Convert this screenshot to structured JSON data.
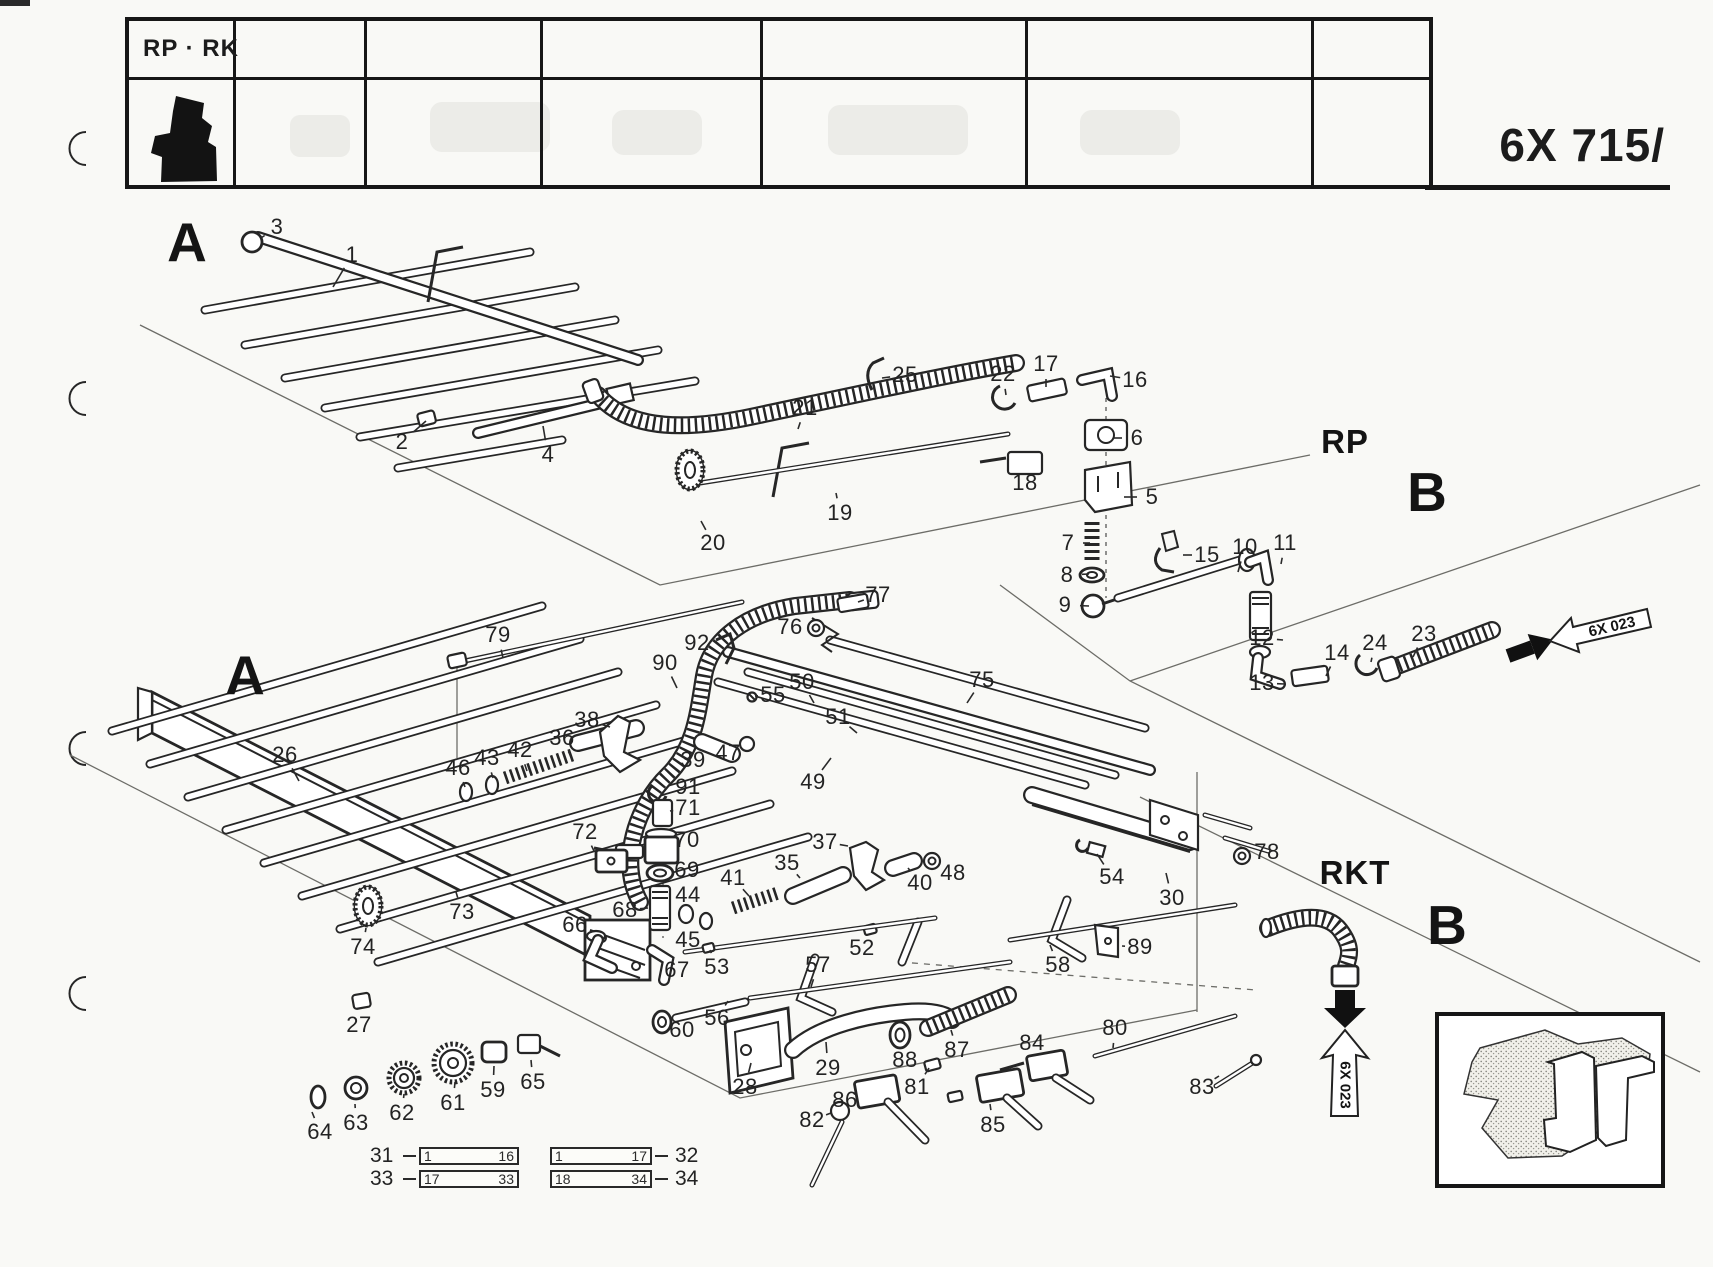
{
  "page": {
    "header_label": "RP · RK",
    "code": "6X 715/"
  },
  "sections": [
    {
      "label": "A",
      "x": 187,
      "y": 242,
      "size": "xl"
    },
    {
      "label": "A",
      "x": 245,
      "y": 675,
      "size": "xl"
    },
    {
      "label": "RP",
      "x": 1345,
      "y": 442,
      "size": "lg"
    },
    {
      "label": "B",
      "x": 1427,
      "y": 492,
      "size": "xl"
    },
    {
      "label": "RKT",
      "x": 1355,
      "y": 873,
      "size": "lg"
    },
    {
      "label": "B",
      "x": 1447,
      "y": 925,
      "size": "xl"
    }
  ],
  "ref_arrows": [
    {
      "label": "6X 023",
      "x": 1612,
      "y": 627,
      "rot": -13
    },
    {
      "label": "6X 023",
      "x": 1345,
      "y": 1085,
      "rot": 90
    }
  ],
  "legend": {
    "rows": [
      {
        "left_ref": "31",
        "boxes": [
          {
            "start": "1",
            "end": "16"
          },
          {
            "start": "1",
            "end": "17"
          }
        ],
        "right_ref": "32"
      },
      {
        "left_ref": "33",
        "boxes": [
          {
            "start": "17",
            "end": "33"
          },
          {
            "start": "18",
            "end": "34"
          }
        ],
        "right_ref": "34"
      }
    ]
  },
  "parts": [
    {
      "n": "1",
      "x": 352,
      "y": 255,
      "lx": 333,
      "ly": 287
    },
    {
      "n": "2",
      "x": 402,
      "y": 442,
      "lx": 426,
      "ly": 421
    },
    {
      "n": "3",
      "x": 277,
      "y": 227,
      "lx": 261,
      "ly": 238
    },
    {
      "n": "4",
      "x": 548,
      "y": 455,
      "lx": 543,
      "ly": 426
    },
    {
      "n": "5",
      "x": 1152,
      "y": 497,
      "lx": 1124,
      "ly": 497
    },
    {
      "n": "6",
      "x": 1137,
      "y": 438,
      "lx": 1113,
      "ly": 438
    },
    {
      "n": "7",
      "x": 1068,
      "y": 543,
      "lx": 1090,
      "ly": 543
    },
    {
      "n": "8",
      "x": 1067,
      "y": 575,
      "lx": 1089,
      "ly": 574
    },
    {
      "n": "9",
      "x": 1065,
      "y": 605,
      "lx": 1089,
      "ly": 606
    },
    {
      "n": "10",
      "x": 1245,
      "y": 547,
      "lx": 1238,
      "ly": 572
    },
    {
      "n": "11",
      "x": 1285,
      "y": 543,
      "lx": 1281,
      "ly": 564
    },
    {
      "n": "12",
      "x": 1262,
      "y": 638,
      "lx": 1283,
      "ly": 640
    },
    {
      "n": "13",
      "x": 1262,
      "y": 683,
      "lx": 1285,
      "ly": 684
    },
    {
      "n": "14",
      "x": 1337,
      "y": 653,
      "lx": 1326,
      "ly": 676
    },
    {
      "n": "15",
      "x": 1207,
      "y": 555,
      "lx": 1183,
      "ly": 555
    },
    {
      "n": "16",
      "x": 1135,
      "y": 380,
      "lx": 1110,
      "ly": 376
    },
    {
      "n": "17",
      "x": 1046,
      "y": 364,
      "lx": 1046,
      "ly": 387
    },
    {
      "n": "18",
      "x": 1025,
      "y": 483,
      "lx": 1026,
      "ly": 466
    },
    {
      "n": "19",
      "x": 840,
      "y": 513,
      "lx": 836,
      "ly": 493
    },
    {
      "n": "20",
      "x": 713,
      "y": 543,
      "lx": 701,
      "ly": 521
    },
    {
      "n": "21",
      "x": 805,
      "y": 408,
      "lx": 798,
      "ly": 429
    },
    {
      "n": "22",
      "x": 1003,
      "y": 374,
      "lx": 1006,
      "ly": 395
    },
    {
      "n": "23",
      "x": 1424,
      "y": 634,
      "lx": 1413,
      "ly": 657
    },
    {
      "n": "24",
      "x": 1375,
      "y": 643,
      "lx": 1371,
      "ly": 662
    },
    {
      "n": "25",
      "x": 905,
      "y": 375,
      "lx": 882,
      "ly": 378
    },
    {
      "n": "26",
      "x": 285,
      "y": 755,
      "lx": 299,
      "ly": 781
    },
    {
      "n": "27",
      "x": 359,
      "y": 1025,
      "lx": 358,
      "ly": 1008
    },
    {
      "n": "28",
      "x": 745,
      "y": 1087,
      "lx": 751,
      "ly": 1063
    },
    {
      "n": "29",
      "x": 828,
      "y": 1068,
      "lx": 826,
      "ly": 1042
    },
    {
      "n": "30",
      "x": 1172,
      "y": 898,
      "lx": 1166,
      "ly": 873
    },
    {
      "n": "35",
      "x": 787,
      "y": 863,
      "lx": 800,
      "ly": 878
    },
    {
      "n": "36",
      "x": 562,
      "y": 738,
      "lx": 572,
      "ly": 759
    },
    {
      "n": "37",
      "x": 825,
      "y": 842,
      "lx": 848,
      "ly": 846
    },
    {
      "n": "38",
      "x": 587,
      "y": 720,
      "lx": 610,
      "ly": 727
    },
    {
      "n": "39",
      "x": 693,
      "y": 760,
      "lx": 702,
      "ly": 748
    },
    {
      "n": "40",
      "x": 920,
      "y": 883,
      "lx": 908,
      "ly": 868
    },
    {
      "n": "41",
      "x": 733,
      "y": 878,
      "lx": 749,
      "ly": 896
    },
    {
      "n": "42",
      "x": 520,
      "y": 750,
      "lx": 527,
      "ly": 771
    },
    {
      "n": "43",
      "x": 487,
      "y": 758,
      "lx": 493,
      "ly": 778
    },
    {
      "n": "44",
      "x": 688,
      "y": 895,
      "lx": 687,
      "ly": 906
    },
    {
      "n": "45",
      "x": 688,
      "y": 940,
      "lx": 701,
      "ly": 929
    },
    {
      "n": "46",
      "x": 458,
      "y": 768,
      "lx": 465,
      "ly": 787
    },
    {
      "n": "47",
      "x": 728,
      "y": 753,
      "lx": 740,
      "ly": 746
    },
    {
      "n": "48",
      "x": 953,
      "y": 873,
      "lx": 938,
      "ly": 864
    },
    {
      "n": "49",
      "x": 813,
      "y": 782,
      "lx": 831,
      "ly": 758
    },
    {
      "n": "50",
      "x": 802,
      "y": 682,
      "lx": 814,
      "ly": 703
    },
    {
      "n": "51",
      "x": 838,
      "y": 717,
      "lx": 857,
      "ly": 733
    },
    {
      "n": "52",
      "x": 862,
      "y": 948,
      "lx": 867,
      "ly": 933
    },
    {
      "n": "53",
      "x": 717,
      "y": 967,
      "lx": 710,
      "ly": 950
    },
    {
      "n": "54",
      "x": 1112,
      "y": 877,
      "lx": 1097,
      "ly": 854
    },
    {
      "n": "55",
      "x": 773,
      "y": 695,
      "lx": 755,
      "ly": 696
    },
    {
      "n": "56",
      "x": 717,
      "y": 1018,
      "lx": 728,
      "ly": 1001
    },
    {
      "n": "57",
      "x": 818,
      "y": 965,
      "lx": 811,
      "ly": 987
    },
    {
      "n": "58",
      "x": 1058,
      "y": 965,
      "lx": 1050,
      "ly": 945
    },
    {
      "n": "59",
      "x": 493,
      "y": 1090,
      "lx": 494,
      "ly": 1066
    },
    {
      "n": "60",
      "x": 682,
      "y": 1030,
      "lx": 671,
      "ly": 1026
    },
    {
      "n": "61",
      "x": 453,
      "y": 1103,
      "lx": 455,
      "ly": 1082
    },
    {
      "n": "62",
      "x": 402,
      "y": 1113,
      "lx": 404,
      "ly": 1094
    },
    {
      "n": "63",
      "x": 356,
      "y": 1123,
      "lx": 355,
      "ly": 1104
    },
    {
      "n": "64",
      "x": 320,
      "y": 1132,
      "lx": 312,
      "ly": 1112
    },
    {
      "n": "65",
      "x": 533,
      "y": 1082,
      "lx": 531,
      "ly": 1060
    },
    {
      "n": "66",
      "x": 575,
      "y": 925,
      "lx": 591,
      "ly": 941
    },
    {
      "n": "67",
      "x": 677,
      "y": 970,
      "lx": 665,
      "ly": 958
    },
    {
      "n": "68",
      "x": 625,
      "y": 910,
      "lx": 648,
      "ly": 908
    },
    {
      "n": "69",
      "x": 687,
      "y": 870,
      "lx": 672,
      "ly": 872
    },
    {
      "n": "70",
      "x": 687,
      "y": 840,
      "lx": 670,
      "ly": 843
    },
    {
      "n": "71",
      "x": 688,
      "y": 808,
      "lx": 670,
      "ly": 811
    },
    {
      "n": "72",
      "x": 585,
      "y": 832,
      "lx": 594,
      "ly": 851
    },
    {
      "n": "73",
      "x": 462,
      "y": 912,
      "lx": 456,
      "ly": 892
    },
    {
      "n": "74",
      "x": 363,
      "y": 947,
      "lx": 366,
      "ly": 928
    },
    {
      "n": "75",
      "x": 982,
      "y": 680,
      "lx": 967,
      "ly": 703
    },
    {
      "n": "76",
      "x": 790,
      "y": 627,
      "lx": 806,
      "ly": 628
    },
    {
      "n": "77",
      "x": 878,
      "y": 595,
      "lx": 858,
      "ly": 602
    },
    {
      "n": "78",
      "x": 1267,
      "y": 852,
      "lx": 1250,
      "ly": 854
    },
    {
      "n": "79",
      "x": 498,
      "y": 635,
      "lx": 503,
      "ly": 658
    },
    {
      "n": "80",
      "x": 1115,
      "y": 1028,
      "lx": 1113,
      "ly": 1048
    },
    {
      "n": "81",
      "x": 917,
      "y": 1087,
      "lx": 929,
      "ly": 1068
    },
    {
      "n": "82",
      "x": 812,
      "y": 1120,
      "lx": 831,
      "ly": 1113
    },
    {
      "n": "83",
      "x": 1202,
      "y": 1087,
      "lx": 1219,
      "ly": 1076
    },
    {
      "n": "84",
      "x": 1032,
      "y": 1043,
      "lx": 1040,
      "ly": 1057
    },
    {
      "n": "85",
      "x": 993,
      "y": 1125,
      "lx": 990,
      "ly": 1104
    },
    {
      "n": "86",
      "x": 845,
      "y": 1100,
      "lx": 858,
      "ly": 1095
    },
    {
      "n": "87",
      "x": 957,
      "y": 1050,
      "lx": 951,
      "ly": 1030
    },
    {
      "n": "88",
      "x": 905,
      "y": 1060,
      "lx": 899,
      "ly": 1046
    },
    {
      "n": "89",
      "x": 1140,
      "y": 947,
      "lx": 1122,
      "ly": 946
    },
    {
      "n": "90",
      "x": 665,
      "y": 663,
      "lx": 677,
      "ly": 688
    },
    {
      "n": "91",
      "x": 688,
      "y": 787,
      "lx": 671,
      "ly": 790
    },
    {
      "n": "92",
      "x": 697,
      "y": 643,
      "lx": 714,
      "ly": 644
    }
  ]
}
